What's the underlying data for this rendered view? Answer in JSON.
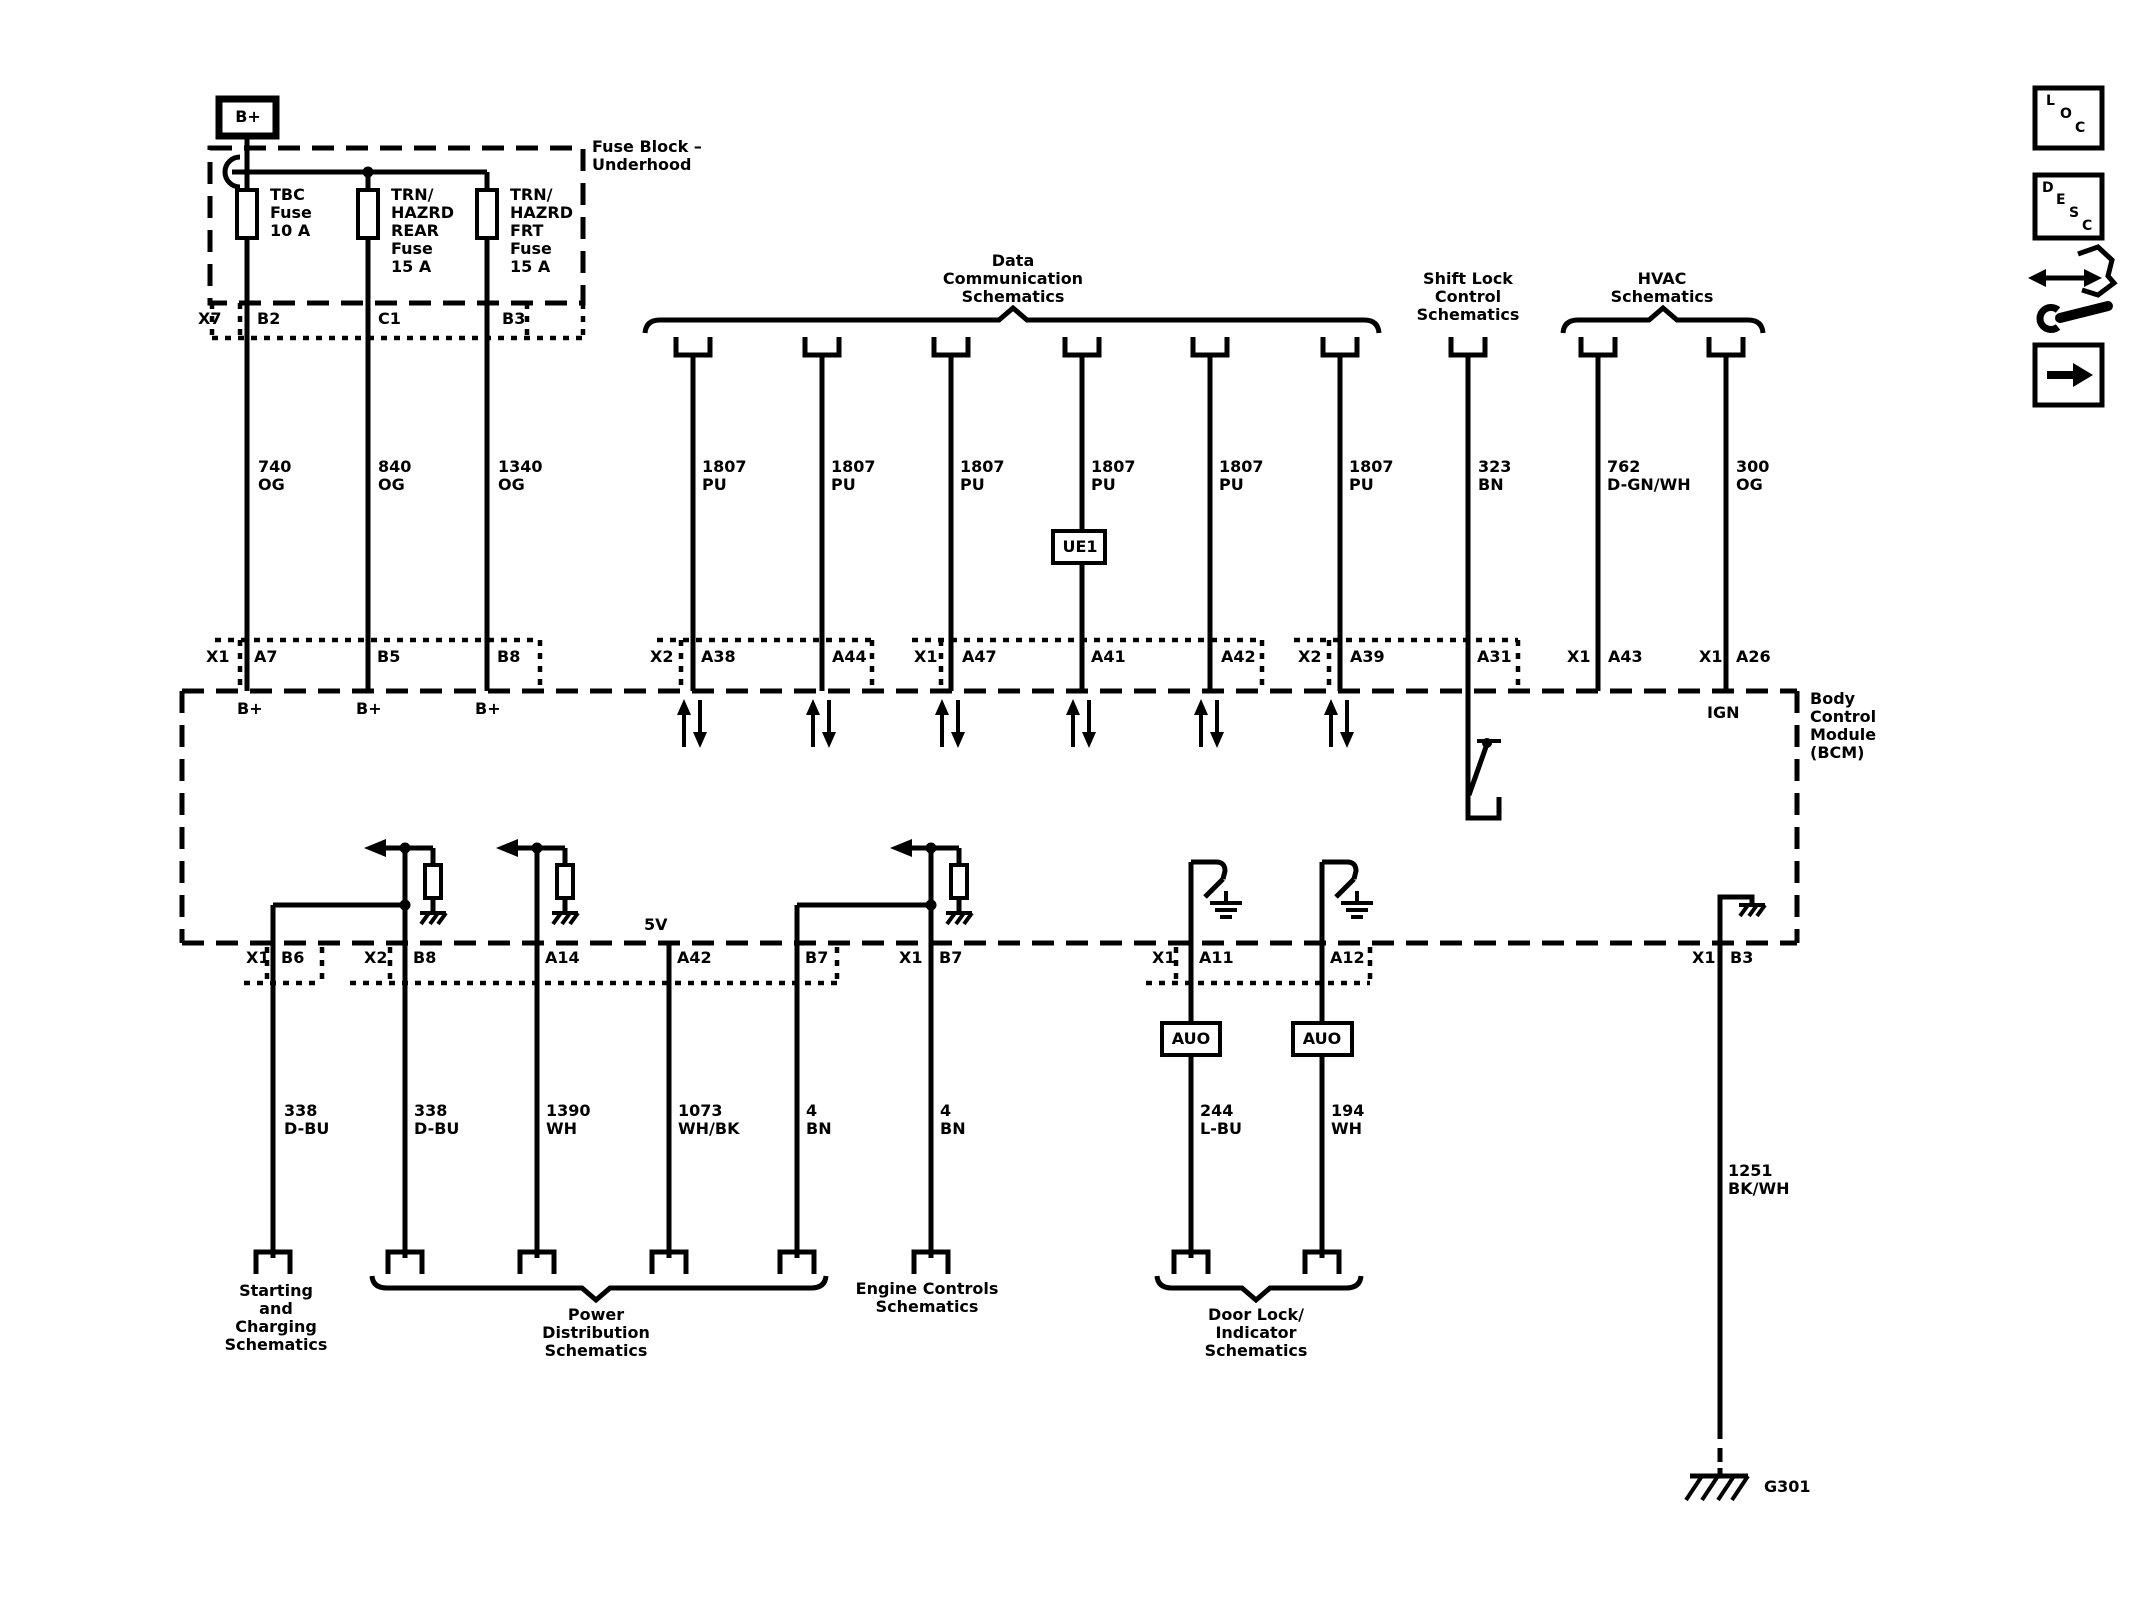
{
  "power_feed": {
    "label": "B+"
  },
  "fuse_block": {
    "title": [
      "Fuse Block –",
      "Underhood"
    ],
    "connector": "X7",
    "pins": [
      "B2",
      "C1",
      "B3"
    ],
    "fuses": [
      {
        "lines": [
          "TBC",
          "Fuse",
          "10 A"
        ]
      },
      {
        "lines": [
          "TRN/",
          "HAZRD",
          "REAR",
          "Fuse",
          "15 A"
        ]
      },
      {
        "lines": [
          "TRN/",
          "HAZRD",
          "FRT",
          "Fuse",
          "15 A"
        ]
      }
    ]
  },
  "feeds": [
    {
      "circuit": "740",
      "color": "OG",
      "bcm_conn": "X1",
      "bcm_pin": "A7",
      "net": "B+"
    },
    {
      "circuit": "840",
      "color": "OG",
      "bcm_pin": "B5",
      "net": "B+"
    },
    {
      "circuit": "1340",
      "color": "OG",
      "bcm_pin": "B8",
      "net": "B+"
    }
  ],
  "data_comm": {
    "title": [
      "Data",
      "Communication",
      "Schematics"
    ],
    "wires": [
      {
        "conn": "X2",
        "pin": "A38",
        "circuit": "1807",
        "color": "PU"
      },
      {
        "pin": "A44",
        "circuit": "1807",
        "color": "PU"
      },
      {
        "conn": "X1",
        "pin": "A47",
        "circuit": "1807",
        "color": "PU"
      },
      {
        "pin": "A41",
        "circuit": "1807",
        "color": "PU",
        "splice": "UE1"
      },
      {
        "pin": "A42",
        "circuit": "1807",
        "color": "PU"
      },
      {
        "conn": "X2",
        "pin": "A39",
        "circuit": "1807",
        "color": "PU"
      }
    ]
  },
  "shift_lock": {
    "title": [
      "Shift Lock",
      "Control",
      "Schematics"
    ],
    "pin": "A31",
    "circuit": "323",
    "color": "BN"
  },
  "hvac": {
    "title": [
      "HVAC",
      "Schematics"
    ],
    "wires": [
      {
        "conn": "X1",
        "pin": "A43",
        "circuit": "762",
        "color": "D-GN/WH"
      },
      {
        "conn": "X1",
        "pin": "A26",
        "circuit": "300",
        "color": "OG",
        "net": "IGN"
      }
    ]
  },
  "bcm": {
    "name": [
      "Body",
      "Control",
      "Module",
      "(BCM)"
    ]
  },
  "outputs": [
    {
      "conn": "X1",
      "pin": "B6",
      "circuit": "338",
      "color": "D-BU"
    },
    {
      "conn": "X2",
      "pin": "B8",
      "circuit": "338",
      "color": "D-BU"
    },
    {
      "pin": "A14",
      "circuit": "1390",
      "color": "WH"
    },
    {
      "pin": "A42",
      "net": "5V",
      "circuit": "1073",
      "color": "WH/BK"
    },
    {
      "pin": "B7",
      "circuit": "4",
      "color": "BN"
    },
    {
      "conn": "X1",
      "pin": "B7",
      "circuit": "4",
      "color": "BN"
    },
    {
      "conn": "X1",
      "pin": "A11",
      "device": "AUO",
      "circuit": "244",
      "color": "L-BU"
    },
    {
      "pin": "A12",
      "device": "AUO",
      "circuit": "194",
      "color": "WH"
    },
    {
      "conn": "X1",
      "pin": "B3",
      "circuit": "1251",
      "color": "BK/WH",
      "ground": "G301"
    }
  ],
  "sections": {
    "starting": [
      "Starting",
      "and",
      "Charging",
      "Schematics"
    ],
    "power_dist": [
      "Power",
      "Distribution",
      "Schematics"
    ],
    "engine": [
      "Engine Controls",
      "Schematics"
    ],
    "door_lock": [
      "Door Lock/",
      "Indicator",
      "Schematics"
    ]
  },
  "toolbar": {
    "loc": [
      "L",
      "O",
      "C"
    ],
    "desc": [
      "D",
      "E",
      "S",
      "C"
    ]
  }
}
